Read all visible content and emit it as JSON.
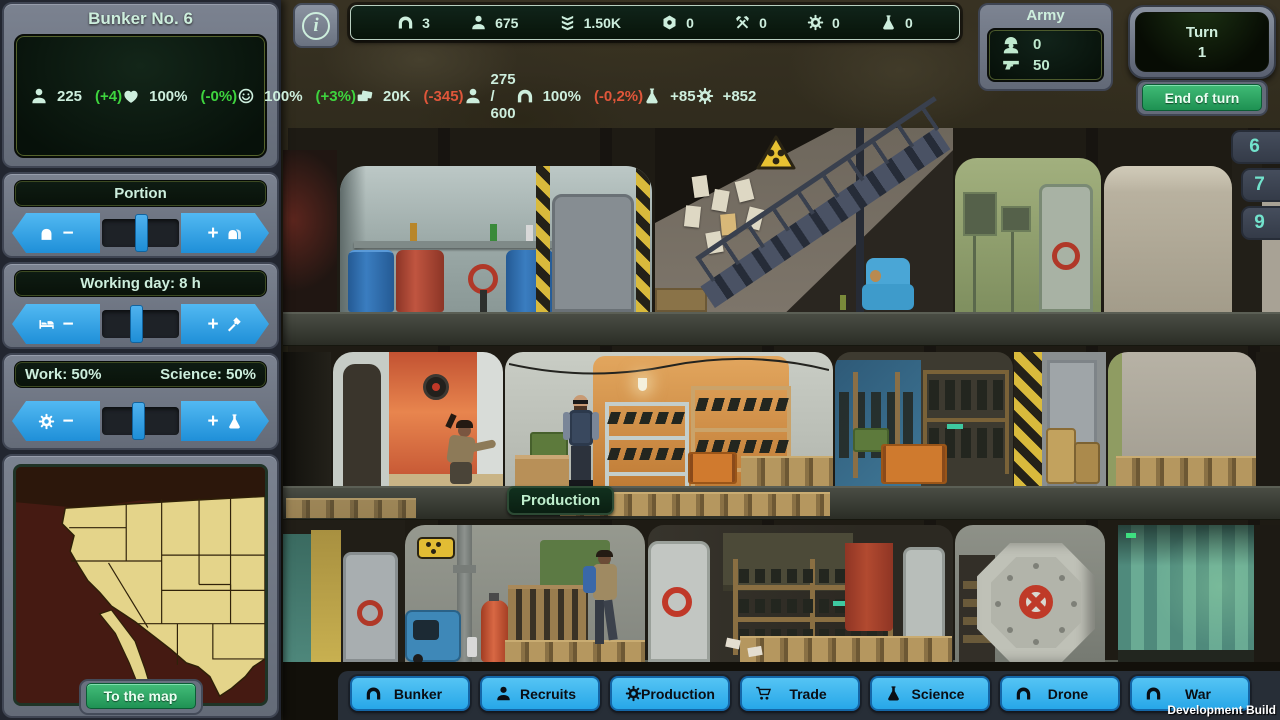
{
  "colors": {
    "accent_blue": "#2fa8ea",
    "mint_text": "#cdeedd",
    "positive_green": "#3ed43e",
    "negative_red": "#e0563a",
    "button_green": "#2aa863",
    "nav_cyan": "#38b6f2",
    "panel_gray": "#6a7180",
    "dark_green_bg": "#0b1a10"
  },
  "bunker_panel": {
    "title": "Bunker No. 6",
    "stats_left": [
      {
        "icon": "population-icon",
        "value": "225",
        "delta": "(+4)"
      },
      {
        "icon": "health-icon",
        "value": "100%",
        "delta": "(-0%)"
      },
      {
        "icon": "morale-icon",
        "value": "100%",
        "delta": "(+3%)"
      },
      {
        "icon": "money-icon",
        "value": "20K",
        "delta": "(-345)"
      }
    ],
    "stats_right": [
      {
        "icon": "capacity-icon",
        "value": "275 / 600",
        "delta": ""
      },
      {
        "icon": "bunker-condition-icon",
        "value": "100%",
        "delta": "(-0,2%)"
      },
      {
        "icon": "science-icon",
        "value": "+85",
        "delta": ""
      },
      {
        "icon": "production-icon",
        "value": "+852",
        "delta": ""
      }
    ]
  },
  "sliders": {
    "portion": {
      "title": "Portion"
    },
    "working_day": {
      "title": "Working day: 8 h"
    },
    "balance": {
      "work_label": "Work: 50%",
      "science_label": "Science: 50%"
    }
  },
  "map": {
    "button_label": "To the map"
  },
  "top_bar": {
    "info_glyph": "i"
  },
  "top_resources": [
    {
      "icon": "bunker-icon",
      "value": "3"
    },
    {
      "icon": "population-icon",
      "value": "675"
    },
    {
      "icon": "rank-icon",
      "value": "1.50K"
    },
    {
      "icon": "components-icon",
      "value": "0"
    },
    {
      "icon": "tools-icon",
      "value": "0"
    },
    {
      "icon": "gear-icon",
      "value": "0"
    },
    {
      "icon": "science-icon",
      "value": "0"
    }
  ],
  "army": {
    "title": "Army",
    "soldiers": "0",
    "weapons": "50"
  },
  "turn": {
    "label": "Turn",
    "number": "1",
    "end_button_label": "End of turn"
  },
  "floor_tabs": [
    "6",
    "7",
    "9"
  ],
  "scene": {
    "room_label": "Production"
  },
  "nav_buttons": [
    {
      "icon": "bunker-icon",
      "label": "Bunker"
    },
    {
      "icon": "recruits-icon",
      "label": "Recruits"
    },
    {
      "icon": "gear-icon",
      "label": "Production"
    },
    {
      "icon": "cart-icon",
      "label": "Trade"
    },
    {
      "icon": "flask-icon",
      "label": "Science"
    },
    {
      "icon": "bunker-icon",
      "label": "Drone"
    },
    {
      "icon": "bunker-icon",
      "label": "War"
    }
  ],
  "footer": {
    "build_label": "Development Build"
  }
}
